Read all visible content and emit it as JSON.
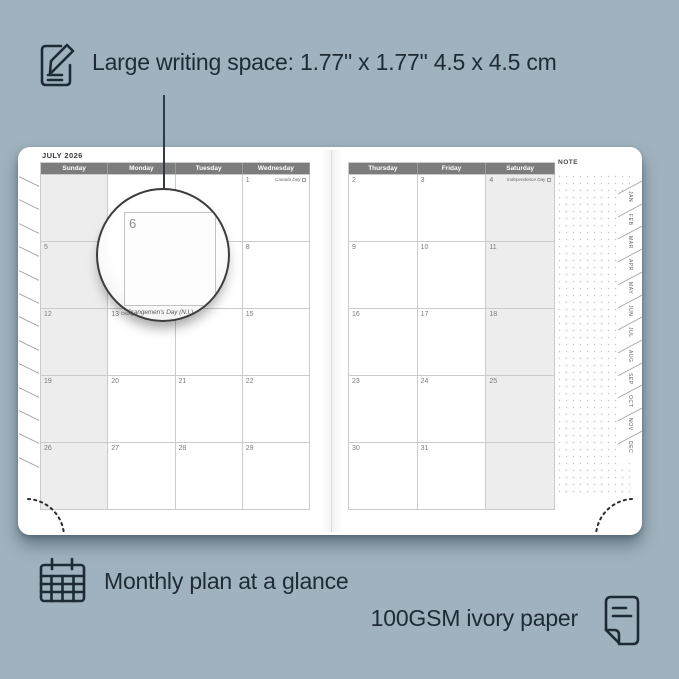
{
  "colors": {
    "bg": "#9FB2BD",
    "ink": "#1F2B34",
    "page": "#FFFFFF",
    "headerbar": "#7C7C7C",
    "shade": "#EDEDED",
    "line": "#CBCBCB",
    "date": "#7A7A7A",
    "holiday": "#666666",
    "tabtext": "#5E5E5E",
    "dots": "#C7C7C7"
  },
  "callout_top": {
    "icon": "note-pencil",
    "text": "Large writing space: 1.77\" x 1.77\" 4.5 x 4.5 cm"
  },
  "callout_monthly": {
    "icon": "calendar-grid",
    "text": "Monthly plan at a glance"
  },
  "callout_paper": {
    "icon": "paper-sheet",
    "text": "100GSM ivory paper"
  },
  "planner": {
    "month_title": "JULY 2026",
    "note_label": "NOTE",
    "day_headers_left": [
      "Sunday",
      "Monday",
      "Tuesday",
      "Wednesday"
    ],
    "day_headers_right": [
      "Thursday",
      "Friday",
      "Saturday"
    ],
    "left_cells": [
      [
        {
          "d": ""
        },
        {
          "d": ""
        },
        {
          "d": ""
        },
        {
          "d": "1",
          "h": "Canada Day"
        }
      ],
      [
        {
          "d": "5"
        },
        {
          "d": "6"
        },
        {
          "d": "7"
        },
        {
          "d": "8"
        }
      ],
      [
        {
          "d": "12"
        },
        {
          "d": "13",
          "h": "Orangemen's Day (N.I.)"
        },
        {
          "d": "14"
        },
        {
          "d": "15"
        }
      ],
      [
        {
          "d": "19"
        },
        {
          "d": "20"
        },
        {
          "d": "21"
        },
        {
          "d": "22"
        }
      ],
      [
        {
          "d": "26"
        },
        {
          "d": "27"
        },
        {
          "d": "28"
        },
        {
          "d": "29"
        }
      ]
    ],
    "right_cells": [
      [
        {
          "d": "2"
        },
        {
          "d": "3"
        },
        {
          "d": "4",
          "h": "Independence Day"
        }
      ],
      [
        {
          "d": "9"
        },
        {
          "d": "10"
        },
        {
          "d": "11"
        }
      ],
      [
        {
          "d": "16"
        },
        {
          "d": "17"
        },
        {
          "d": "18"
        }
      ],
      [
        {
          "d": "23"
        },
        {
          "d": "24"
        },
        {
          "d": "25"
        }
      ],
      [
        {
          "d": "30"
        },
        {
          "d": "31"
        },
        {
          "d": ""
        }
      ]
    ],
    "month_tabs": [
      "JAN",
      "FEB",
      "MAR",
      "APR",
      "MAY",
      "JUN",
      "JUL",
      "AUG",
      "SEP",
      "OCT",
      "NOV",
      "DEC"
    ],
    "magnifier": {
      "left_day": "6",
      "right_day": "7",
      "holiday": "Orangemen's Day (N.I.)"
    }
  }
}
